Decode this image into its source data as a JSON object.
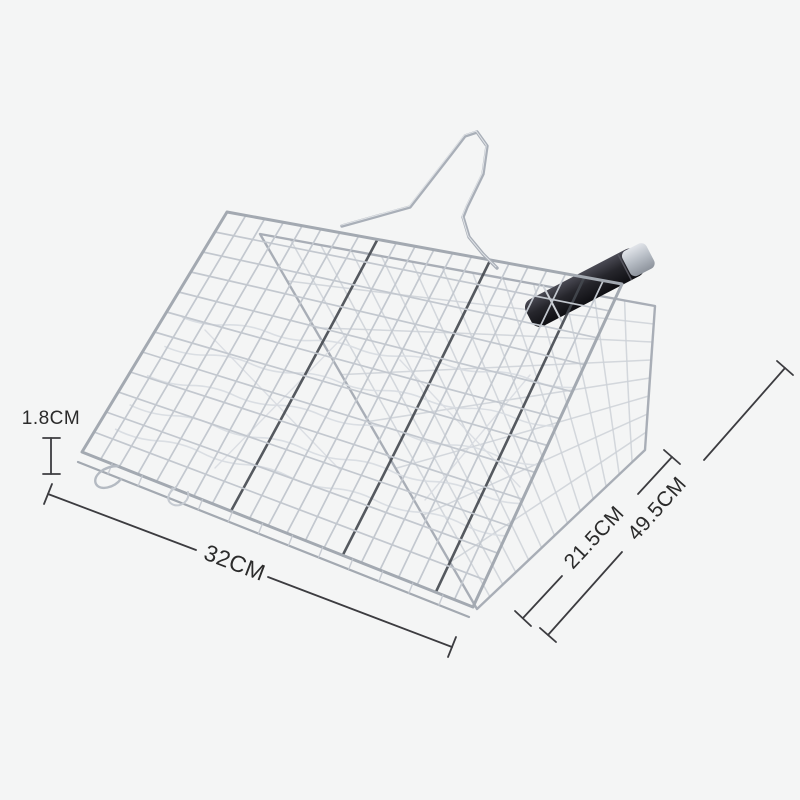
{
  "product": {
    "description": "Chrome wire BBQ fish grill basket with black handle, shown on a light gray background with size annotation lines",
    "labels": {
      "depth": "1.8CM",
      "front_width": "32CM",
      "side_width": "21.5CM",
      "total_length": "49.5CM"
    },
    "colors": {
      "background": "#f4f5f5",
      "wire": "#c3c8cf",
      "wire_dark": "#44484f",
      "frame": "#a3a9b1",
      "lid_wire": "#ccd1d7",
      "inner_wire": "#d8dce1",
      "handle": "#26262c",
      "handle_ferrule": "#b6bcc4",
      "dim_line": "#3c3c40",
      "dim_text": "#2b2b2b"
    }
  }
}
